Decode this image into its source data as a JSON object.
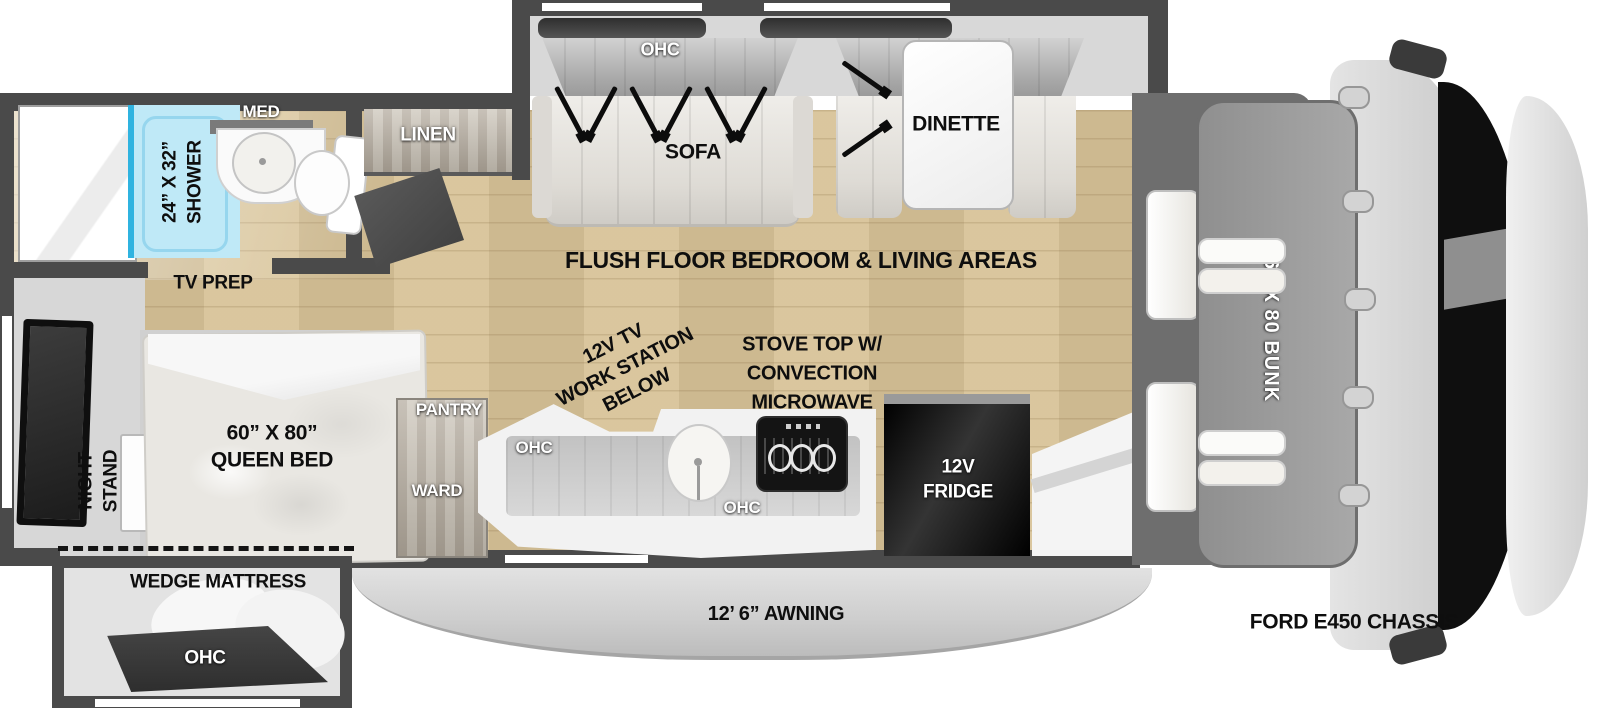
{
  "colors": {
    "wall": "#4a4a4a",
    "wood_floor": "#d8c398",
    "shower_blue": "#bfe9f7",
    "shower_edge": "#2fb3e0",
    "fridge_black": "#111111",
    "bunk_gray": "#9a9a9a",
    "awning_gray": "#d6d6d6"
  },
  "labels": {
    "med": "MED",
    "shower": "24” X 32”\nSHOWER",
    "linen": "LINEN",
    "tv_prep": "TV PREP",
    "sofa_ohc": "OHC",
    "sofa": "SOFA",
    "dinette_ohc": "OHC",
    "dinette": "DINETTE",
    "flush_floor": "FLUSH FLOOR BEDROOM & LIVING AREAS",
    "workstation": "12V TV\nWORK STATION\nBELOW",
    "stove": "STOVE TOP W/\nCONVECTION\nMICROWAVE",
    "night_stand": "NIGHT\nSTAND",
    "queen_bed": "60” X 80”\nQUEEN BED",
    "wedge_mattress": "WEDGE MATTRESS",
    "bedroom_ohc": "OHC",
    "pantry": "PANTRY",
    "ward": "WARD",
    "kitchen_ohc_upper": "OHC",
    "kitchen_ohc_lower": "OHC",
    "fridge": "12V\nFRIDGE",
    "awning": "12’ 6” AWNING",
    "bunk": "60 X 80 BUNK",
    "chassis": "FORD E450 CHASSIS"
  }
}
